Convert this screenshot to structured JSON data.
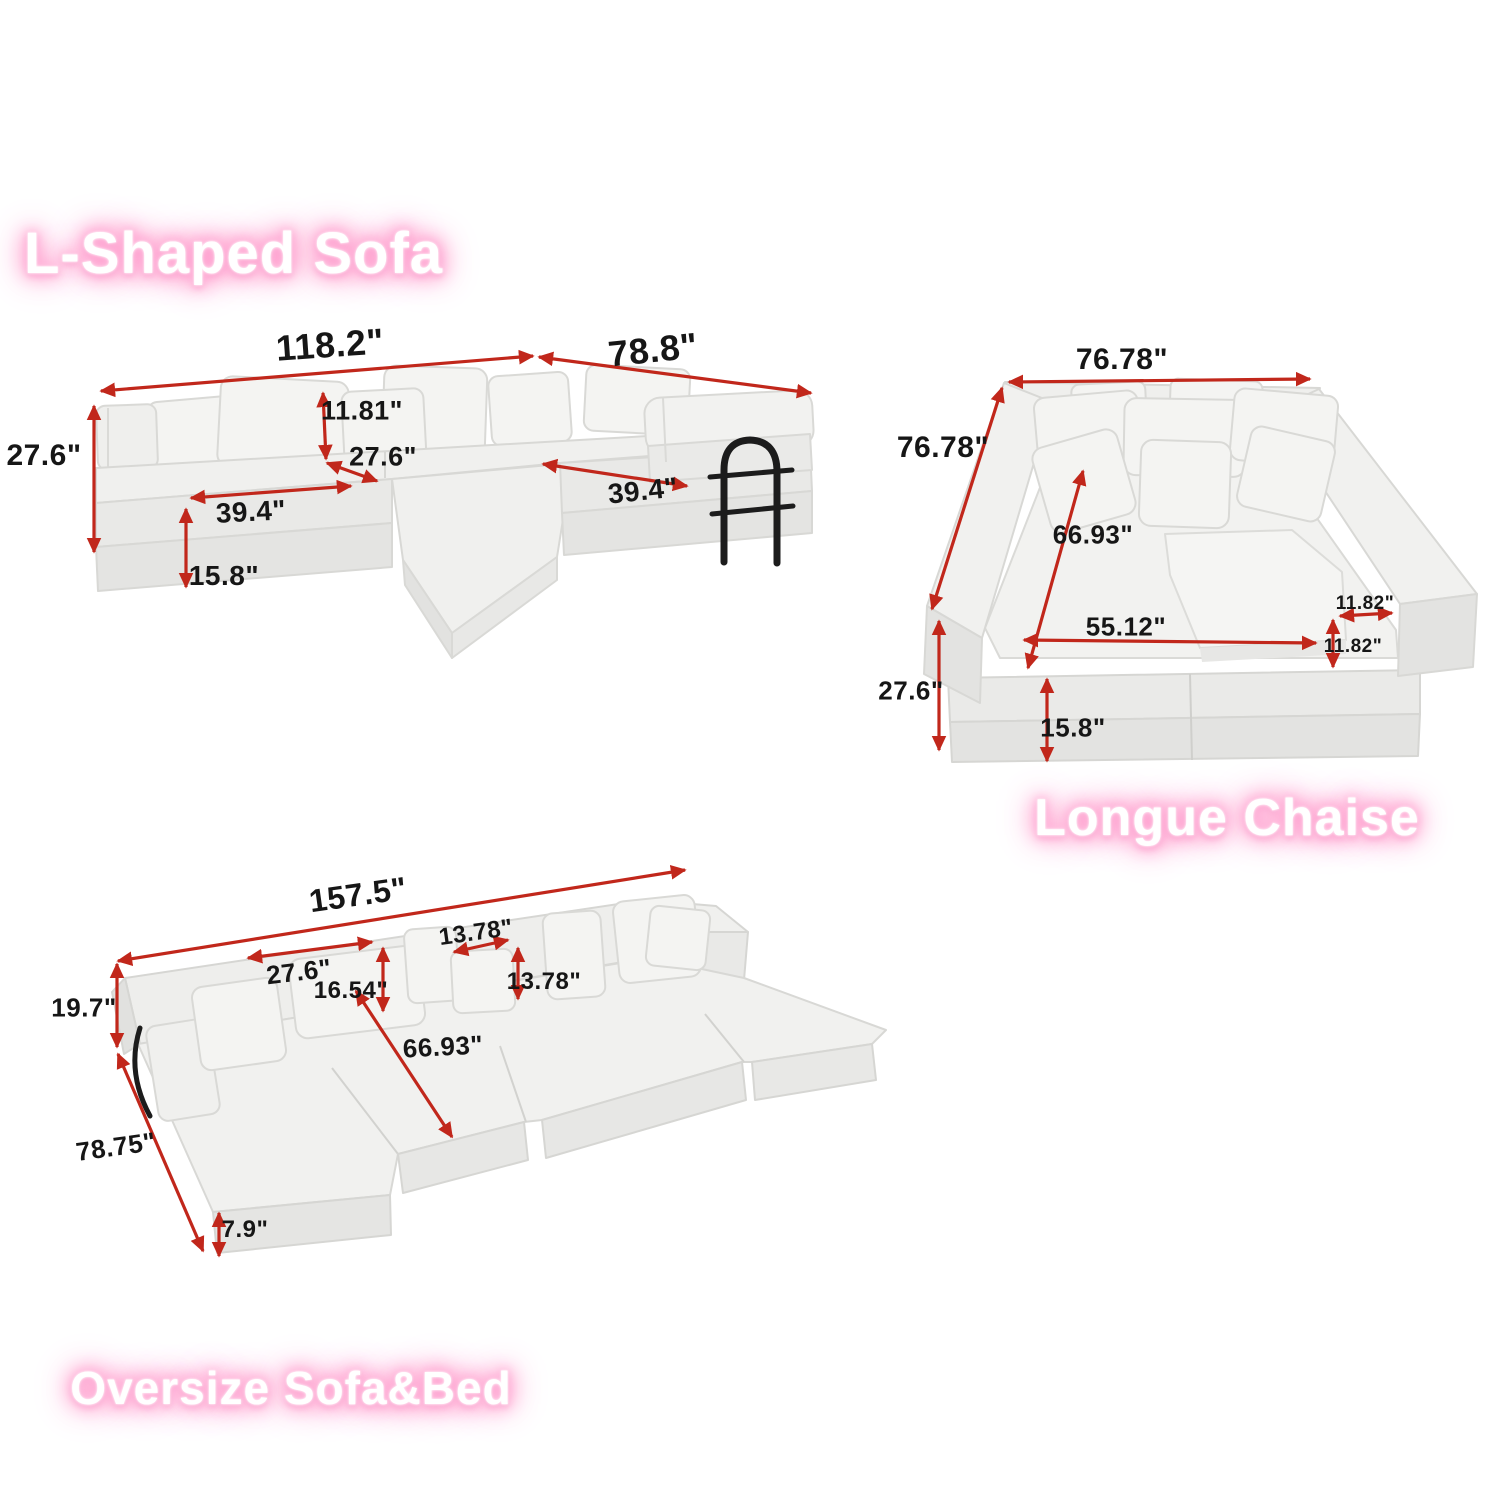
{
  "page": {
    "type": "product-dimension-infographic",
    "background": "#ffffff",
    "units": "inches"
  },
  "colors": {
    "arrow": "#c1271b",
    "dimension_text": "#161616",
    "title_text": "#ffffff",
    "title_glow": "#ff8fc6",
    "sofa_top": "#f1f1ef",
    "sofa_front": "#e6e6e4",
    "sofa_side": "#dcdcda",
    "sofa_outline": "#d7d7d4",
    "handle_black": "#1c1c1c"
  },
  "sections": [
    {
      "id": "l-shaped-sofa",
      "title": "L-Shaped Sofa",
      "dimensions": [
        {
          "name": "total-width",
          "value": "118.2\""
        },
        {
          "name": "chaise-length",
          "value": "78.8\""
        },
        {
          "name": "overall-height",
          "value": "27.6\""
        },
        {
          "name": "pillow-height",
          "value": "11.81\""
        },
        {
          "name": "seat-depth",
          "value": "27.6\""
        },
        {
          "name": "seat-width-left",
          "value": "39.4\""
        },
        {
          "name": "base-height",
          "value": "15.8\""
        },
        {
          "name": "seat-width-right",
          "value": "39.4\""
        }
      ]
    },
    {
      "id": "longue-chaise",
      "title": "Longue Chaise",
      "dimensions": [
        {
          "name": "total-width",
          "value": "76.78\""
        },
        {
          "name": "total-depth",
          "value": "76.78\""
        },
        {
          "name": "inner-depth",
          "value": "66.93\""
        },
        {
          "name": "inner-width",
          "value": "55.12\""
        },
        {
          "name": "arm-width",
          "value": "11.82\""
        },
        {
          "name": "arm-height",
          "value": "11.82\""
        },
        {
          "name": "overall-height",
          "value": "27.6\""
        },
        {
          "name": "base-height",
          "value": "15.8\""
        }
      ]
    },
    {
      "id": "oversize-sofa-bed",
      "title": "Oversize Sofa&Bed",
      "dimensions": [
        {
          "name": "total-width",
          "value": "157.5\""
        },
        {
          "name": "back-cushion-width",
          "value": "27.6\""
        },
        {
          "name": "back-cushion-height",
          "value": "16.54\""
        },
        {
          "name": "pillow-width",
          "value": "13.78\""
        },
        {
          "name": "pillow-height",
          "value": "13.78\""
        },
        {
          "name": "back-height",
          "value": "19.7\""
        },
        {
          "name": "bed-length",
          "value": "66.93\""
        },
        {
          "name": "total-depth",
          "value": "78.75\""
        },
        {
          "name": "mattress-height",
          "value": "7.9\""
        }
      ]
    }
  ]
}
